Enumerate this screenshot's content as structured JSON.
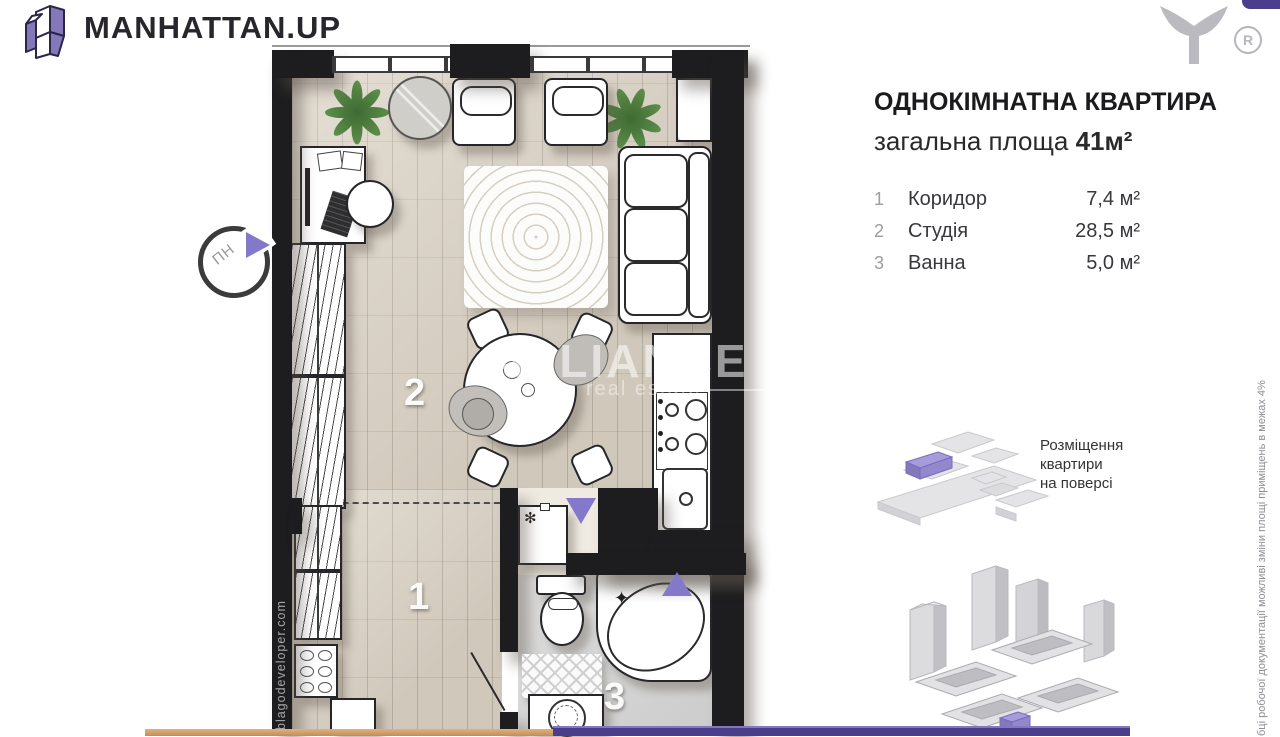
{
  "brand": {
    "logo_text": "MANHATTAN.UP",
    "registered_mark": "R"
  },
  "apartment": {
    "title": "ОДНОКІМНАТНА КВАРТИРА",
    "total_area_label": "загальна площа ",
    "total_area_value": "41м²",
    "rooms": [
      {
        "num": "1",
        "name": "Коридор",
        "area": "7,4 м²"
      },
      {
        "num": "2",
        "name": "Студія",
        "area": "28,5 м²"
      },
      {
        "num": "3",
        "name": "Ванна",
        "area": "5,0 м²"
      }
    ]
  },
  "floor_location": {
    "caption": "Розміщення\nквартири\nна поверсі"
  },
  "plan": {
    "room_labels": {
      "corridor": "1",
      "studio": "2",
      "bath": "3"
    },
    "compass_label": "ПН",
    "freeze_mark": "✻",
    "sparkle_mark": "✦"
  },
  "watermark": {
    "line1": "ALLIANCE",
    "line2": "real estate"
  },
  "side_texts": {
    "left_vertical": "blagodeveloper.com",
    "right_vertical": "бці робочої документації можливі зміни площі приміщень в межах 4%"
  },
  "colors": {
    "accent_purple": "#8478CB",
    "deep_purple": "#4A3D8C",
    "wall_black": "#1D1D1F",
    "floor_beige": "#DBD3C5",
    "bar_orange": "#CB9A67"
  }
}
